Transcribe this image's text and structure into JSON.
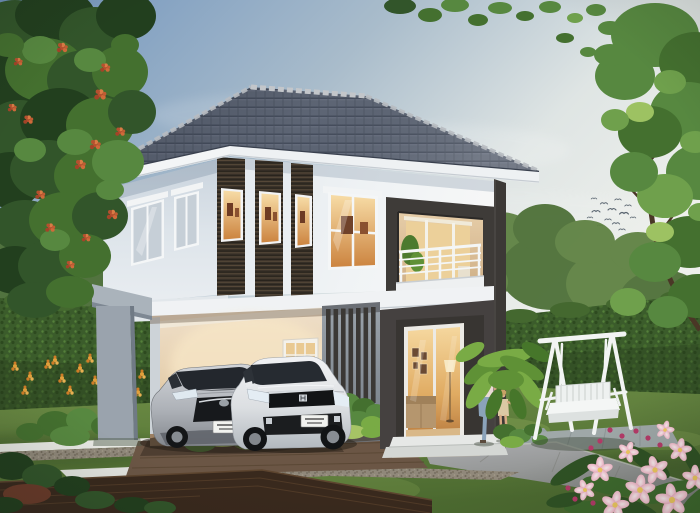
{
  "scene": {
    "description": "Architectural rendering of a modern two-story house at dusk: grey hip tile roof, white walls with dark wood-slat accent window fins, recessed balcony with white railing, carport sheltering a silver sedan and a white hatchback, charcoal-framed lit sliding glass door, white A-frame garden swing, a woman walking hand-in-hand with a child, green lawns, trimmed hedges, trees and pink flowering plants in the foreground",
    "time_of_day": "dusk",
    "no_visible_text": true
  },
  "objects": [
    {
      "label": "two-story-house"
    },
    {
      "label": "hip-tile-roof"
    },
    {
      "label": "slat-accent-windows"
    },
    {
      "label": "balcony-with-railing"
    },
    {
      "label": "carport"
    },
    {
      "label": "silver-sedan-car"
    },
    {
      "label": "white-hatchback-car"
    },
    {
      "label": "sliding-glass-door"
    },
    {
      "label": "entry-steps"
    },
    {
      "label": "garden-swing-bench"
    },
    {
      "label": "woman"
    },
    {
      "label": "child"
    },
    {
      "label": "left-tree-with-red-blossoms"
    },
    {
      "label": "right-tree"
    },
    {
      "label": "hedges"
    },
    {
      "label": "orange-garden-flowers"
    },
    {
      "label": "pink-plumeria-flowers"
    },
    {
      "label": "lawn"
    },
    {
      "label": "stone-pavers"
    },
    {
      "label": "wood-deck"
    },
    {
      "label": "walkway"
    },
    {
      "label": "flying-birds"
    }
  ],
  "palette": {
    "sky_top": "#6f93bd",
    "sky_light": "#eef0ec",
    "roof": "#5d6574",
    "fascia": "#f3f5f6",
    "wall": "#ecf0f3",
    "slat_wood": "#362f27",
    "charcoal": "#3e3b38",
    "warm_window": "#e8a85c",
    "column_grey": "#9aa3ad",
    "lawn": "#5e7e3a",
    "hedge": "#3b5c2b",
    "deck": "#39291d",
    "walkway": "#9b9d98",
    "swing_white": "#f2f4f3",
    "car_silver": "#b9bcc2",
    "car_white": "#e8eaec",
    "pink_flower": "#efa9c0",
    "t1": "#223f1e",
    "t2": "#32552a",
    "t3": "#44702f",
    "t4": "#578840",
    "t5": "#6fa04c",
    "y1": "#9dc262",
    "y2": "#a6c465",
    "bg1": "#4e7038",
    "bg2": "#5f8243",
    "p1": "#5f9136",
    "p2": "#79ab45",
    "p3": "#46762a",
    "p4": "#2f5224",
    "p5": "#3e6a2d",
    "mar": "#6b3b2a",
    "mag": "#b43a68"
  },
  "scene_items": {
    "birds": [
      [
        596,
        212,
        1
      ],
      [
        604,
        204,
        0.9
      ],
      [
        612,
        210,
        1
      ],
      [
        618,
        200,
        0.8
      ],
      [
        624,
        214,
        1.1
      ],
      [
        608,
        220,
        0.8
      ],
      [
        600,
        226,
        0.7
      ],
      [
        616,
        224,
        0.9
      ],
      [
        628,
        206,
        0.8
      ],
      [
        590,
        218,
        0.7
      ],
      [
        622,
        230,
        0.8
      ],
      [
        633,
        218,
        0.7
      ],
      [
        594,
        199,
        0.7
      ]
    ],
    "foliage": {
      "bg_left": [
        [
          8,
          268,
          46,
          36,
          "bg1"
        ],
        [
          60,
          282,
          52,
          36,
          "bg2"
        ],
        [
          118,
          292,
          42,
          30,
          "bg1"
        ],
        [
          152,
          302,
          30,
          20,
          "bg2"
        ],
        [
          35,
          245,
          30,
          22,
          "bg2"
        ]
      ],
      "bg_right": [
        [
          500,
          252,
          44,
          40,
          "bg2"
        ],
        [
          552,
          272,
          52,
          38,
          "bg1"
        ],
        [
          612,
          284,
          46,
          34,
          "bg2"
        ],
        [
          545,
          228,
          32,
          24,
          "bg1"
        ],
        [
          662,
          298,
          42,
          28,
          "bg1"
        ],
        [
          478,
          282,
          30,
          22,
          "bg2"
        ],
        [
          585,
          242,
          30,
          22,
          "bg2"
        ],
        [
          638,
          252,
          28,
          20,
          "bg2"
        ]
      ],
      "left_tree": [
        [
          15,
          30,
          38,
          30,
          "t2"
        ],
        [
          55,
          15,
          40,
          26,
          "t1"
        ],
        [
          95,
          35,
          36,
          28,
          "t2"
        ],
        [
          126,
          16,
          30,
          24,
          "t1"
        ],
        [
          8,
          85,
          34,
          30,
          "t1"
        ],
        [
          45,
          70,
          40,
          32,
          "t3"
        ],
        [
          85,
          80,
          38,
          30,
          "t2"
        ],
        [
          120,
          72,
          28,
          26,
          "t3"
        ],
        [
          20,
          130,
          36,
          30,
          "t2"
        ],
        [
          60,
          120,
          40,
          32,
          "t1"
        ],
        [
          100,
          125,
          34,
          28,
          "t3"
        ],
        [
          132,
          112,
          24,
          22,
          "t2"
        ],
        [
          10,
          180,
          32,
          28,
          "t1"
        ],
        [
          48,
          170,
          38,
          30,
          "t2"
        ],
        [
          88,
          176,
          34,
          28,
          "t3"
        ],
        [
          118,
          162,
          26,
          22,
          "t4"
        ],
        [
          25,
          226,
          34,
          26,
          "t2"
        ],
        [
          65,
          220,
          36,
          28,
          "t3"
        ],
        [
          100,
          216,
          28,
          24,
          "t2"
        ],
        [
          15,
          270,
          30,
          24,
          "t1"
        ],
        [
          50,
          266,
          32,
          26,
          "t2"
        ],
        [
          85,
          256,
          26,
          22,
          "t3"
        ],
        [
          35,
          300,
          28,
          18,
          "t2"
        ],
        [
          70,
          292,
          24,
          16,
          "t3"
        ],
        [
          40,
          50,
          18,
          14,
          "t4"
        ],
        [
          90,
          60,
          16,
          12,
          "t4"
        ],
        [
          30,
          150,
          16,
          12,
          "t4"
        ],
        [
          75,
          142,
          18,
          13,
          "t4"
        ],
        [
          110,
          190,
          14,
          10,
          "t4"
        ],
        [
          55,
          240,
          15,
          11,
          "t4"
        ],
        [
          8,
          45,
          16,
          12,
          "t3"
        ],
        [
          125,
          45,
          14,
          11,
          "t3"
        ]
      ],
      "right_tree": [
        [
          655,
          35,
          44,
          32,
          "t4"
        ],
        [
          695,
          62,
          36,
          30,
          "t3"
        ],
        [
          625,
          76,
          30,
          24,
          "t4"
        ],
        [
          688,
          112,
          38,
          30,
          "t4"
        ],
        [
          650,
          132,
          32,
          26,
          "t3"
        ],
        [
          700,
          172,
          34,
          28,
          "t4"
        ],
        [
          665,
          196,
          28,
          22,
          "t5"
        ],
        [
          634,
          172,
          24,
          20,
          "t4"
        ],
        [
          690,
          242,
          34,
          26,
          "t3"
        ],
        [
          655,
          262,
          26,
          20,
          "t4"
        ],
        [
          698,
          296,
          30,
          22,
          "t3"
        ],
        [
          668,
          312,
          20,
          16,
          "t4"
        ],
        [
          628,
          302,
          18,
          14,
          "t5"
        ],
        [
          670,
          82,
          16,
          12,
          "t5"
        ],
        [
          640,
          112,
          14,
          10,
          "y1"
        ],
        [
          695,
          142,
          15,
          11,
          "t5"
        ],
        [
          660,
          232,
          14,
          10,
          "y1"
        ],
        [
          700,
          212,
          12,
          9,
          "t5"
        ],
        [
          615,
          120,
          14,
          11,
          "t5"
        ],
        [
          610,
          55,
          16,
          11,
          "t4"
        ]
      ],
      "top_leaves": [
        [
          400,
          6,
          16,
          8,
          "t2"
        ],
        [
          430,
          15,
          12,
          7,
          "t3"
        ],
        [
          455,
          5,
          14,
          7,
          "t4"
        ],
        [
          478,
          20,
          10,
          6,
          "t3"
        ],
        [
          500,
          8,
          12,
          6,
          "t4"
        ],
        [
          525,
          16,
          9,
          5,
          "t3"
        ],
        [
          550,
          7,
          11,
          6,
          "t4"
        ],
        [
          575,
          18,
          8,
          5,
          "t5"
        ],
        [
          596,
          10,
          10,
          6,
          "t4"
        ],
        [
          565,
          38,
          9,
          5,
          "t3"
        ],
        [
          610,
          28,
          12,
          7,
          "t4"
        ],
        [
          588,
          52,
          8,
          5,
          "t4"
        ]
      ],
      "palm": [
        [
          486,
          368,
          26,
          9,
          "p1",
          -35
        ],
        [
          505,
          358,
          28,
          8,
          "p2",
          -10
        ],
        [
          522,
          368,
          24,
          8,
          "p1",
          25
        ],
        [
          480,
          390,
          22,
          8,
          "p2",
          -55
        ],
        [
          530,
          390,
          22,
          8,
          "p2",
          55
        ],
        [
          506,
          380,
          18,
          10,
          "p1",
          0
        ],
        [
          494,
          404,
          16,
          7,
          "p3",
          -70
        ],
        [
          518,
          404,
          16,
          7,
          "p3",
          70
        ],
        [
          470,
          352,
          16,
          7,
          "p2",
          -30
        ],
        [
          536,
          352,
          16,
          7,
          "p3",
          30
        ]
      ],
      "planter": [
        [
          332,
          408,
          12,
          10,
          "t3"
        ],
        [
          348,
          404,
          13,
          11,
          "t4"
        ],
        [
          364,
          408,
          12,
          10,
          "t3"
        ],
        [
          376,
          412,
          10,
          8,
          "t4"
        ],
        [
          340,
          422,
          14,
          9,
          "p2"
        ],
        [
          358,
          420,
          14,
          9,
          "t4"
        ],
        [
          372,
          424,
          11,
          8,
          "p2"
        ],
        [
          330,
          430,
          12,
          7,
          "y2"
        ],
        [
          352,
          432,
          14,
          7,
          "y2"
        ],
        [
          372,
          432,
          11,
          6,
          "p2"
        ]
      ],
      "garden_bushes": [
        [
          55,
          424,
          18,
          13,
          "t3"
        ],
        [
          82,
          420,
          16,
          12,
          "t4"
        ],
        [
          105,
          426,
          14,
          10,
          "t3"
        ],
        [
          70,
          436,
          20,
          10,
          "t4"
        ],
        [
          30,
          432,
          14,
          9,
          "t3"
        ],
        [
          222,
          436,
          26,
          11,
          "y2"
        ],
        [
          250,
          442,
          18,
          8,
          "p2"
        ],
        [
          200,
          444,
          16,
          8,
          "t4"
        ],
        [
          170,
          430,
          14,
          8,
          "t3"
        ]
      ],
      "bed_right": [
        [
          505,
          432,
          12,
          8,
          "t3"
        ],
        [
          520,
          436,
          11,
          7,
          "t4"
        ],
        [
          533,
          430,
          9,
          6,
          "t3"
        ],
        [
          512,
          442,
          12,
          6,
          "p2"
        ],
        [
          540,
          440,
          8,
          5,
          "t4"
        ]
      ],
      "deck_shrubs": [
        [
          12,
          466,
          22,
          14,
          "t1"
        ],
        [
          42,
          476,
          20,
          12,
          "t2"
        ],
        [
          72,
          486,
          18,
          10,
          "t1"
        ],
        [
          27,
          494,
          24,
          10,
          "mar"
        ],
        [
          95,
          500,
          20,
          9,
          "t2"
        ],
        [
          132,
          505,
          18,
          8,
          "t1"
        ],
        [
          160,
          508,
          16,
          7,
          "t2"
        ],
        [
          5,
          505,
          18,
          8,
          "t1"
        ]
      ],
      "corner_leaves": [
        [
          575,
          470,
          28,
          8,
          "p4",
          -30
        ],
        [
          612,
          486,
          30,
          9,
          "p5",
          10
        ],
        [
          648,
          462,
          26,
          8,
          "p4",
          35
        ],
        [
          668,
          492,
          32,
          9,
          "p5",
          -15
        ],
        [
          695,
          462,
          24,
          8,
          "p4",
          60
        ],
        [
          590,
          508,
          26,
          7,
          "p5",
          0
        ],
        [
          632,
          508,
          28,
          8,
          "p4",
          20
        ],
        [
          700,
          500,
          24,
          9,
          "p5",
          -40
        ],
        [
          566,
          500,
          20,
          7,
          "p4",
          -10
        ]
      ]
    },
    "flowers": {
      "tree_red": [
        [
          62,
          48,
          1
        ],
        [
          100,
          95,
          1.1
        ],
        [
          28,
          120,
          0.9
        ],
        [
          80,
          165,
          1
        ],
        [
          112,
          215,
          1
        ],
        [
          50,
          228,
          0.9
        ],
        [
          18,
          62,
          0.8
        ],
        [
          95,
          145,
          1
        ],
        [
          40,
          195,
          0.9
        ],
        [
          70,
          265,
          0.8
        ],
        [
          120,
          132,
          0.9
        ],
        [
          12,
          108,
          0.8
        ],
        [
          105,
          68,
          0.9
        ],
        [
          86,
          238,
          0.8
        ]
      ],
      "orange": [
        [
          15,
          368
        ],
        [
          30,
          378
        ],
        [
          48,
          366
        ],
        [
          62,
          380
        ],
        [
          80,
          370
        ],
        [
          95,
          382
        ],
        [
          112,
          372
        ],
        [
          128,
          384
        ],
        [
          142,
          376
        ],
        [
          25,
          392
        ],
        [
          70,
          392
        ],
        [
          105,
          392
        ],
        [
          138,
          394
        ],
        [
          55,
          362
        ],
        [
          90,
          360
        ],
        [
          120,
          390
        ]
      ],
      "plumeria": [
        [
          600,
          470,
          1.1,
          0
        ],
        [
          628,
          452,
          0.9,
          20
        ],
        [
          655,
          470,
          1.2,
          -15
        ],
        [
          680,
          450,
          1.0,
          10
        ],
        [
          640,
          490,
          1.3,
          5
        ],
        [
          672,
          500,
          1.4,
          -8
        ],
        [
          695,
          478,
          1.1,
          0
        ],
        [
          615,
          505,
          1.2,
          12
        ],
        [
          585,
          490,
          0.9,
          -20
        ],
        [
          665,
          430,
          0.8,
          15
        ]
      ],
      "magenta": [
        [
          610,
          430
        ],
        [
          622,
          436
        ],
        [
          600,
          441
        ],
        [
          636,
          431
        ],
        [
          648,
          438
        ],
        [
          591,
          448
        ],
        [
          660,
          445
        ],
        [
          583,
          494
        ],
        [
          593,
          503
        ],
        [
          575,
          499
        ],
        [
          568,
          488
        ]
      ]
    }
  }
}
